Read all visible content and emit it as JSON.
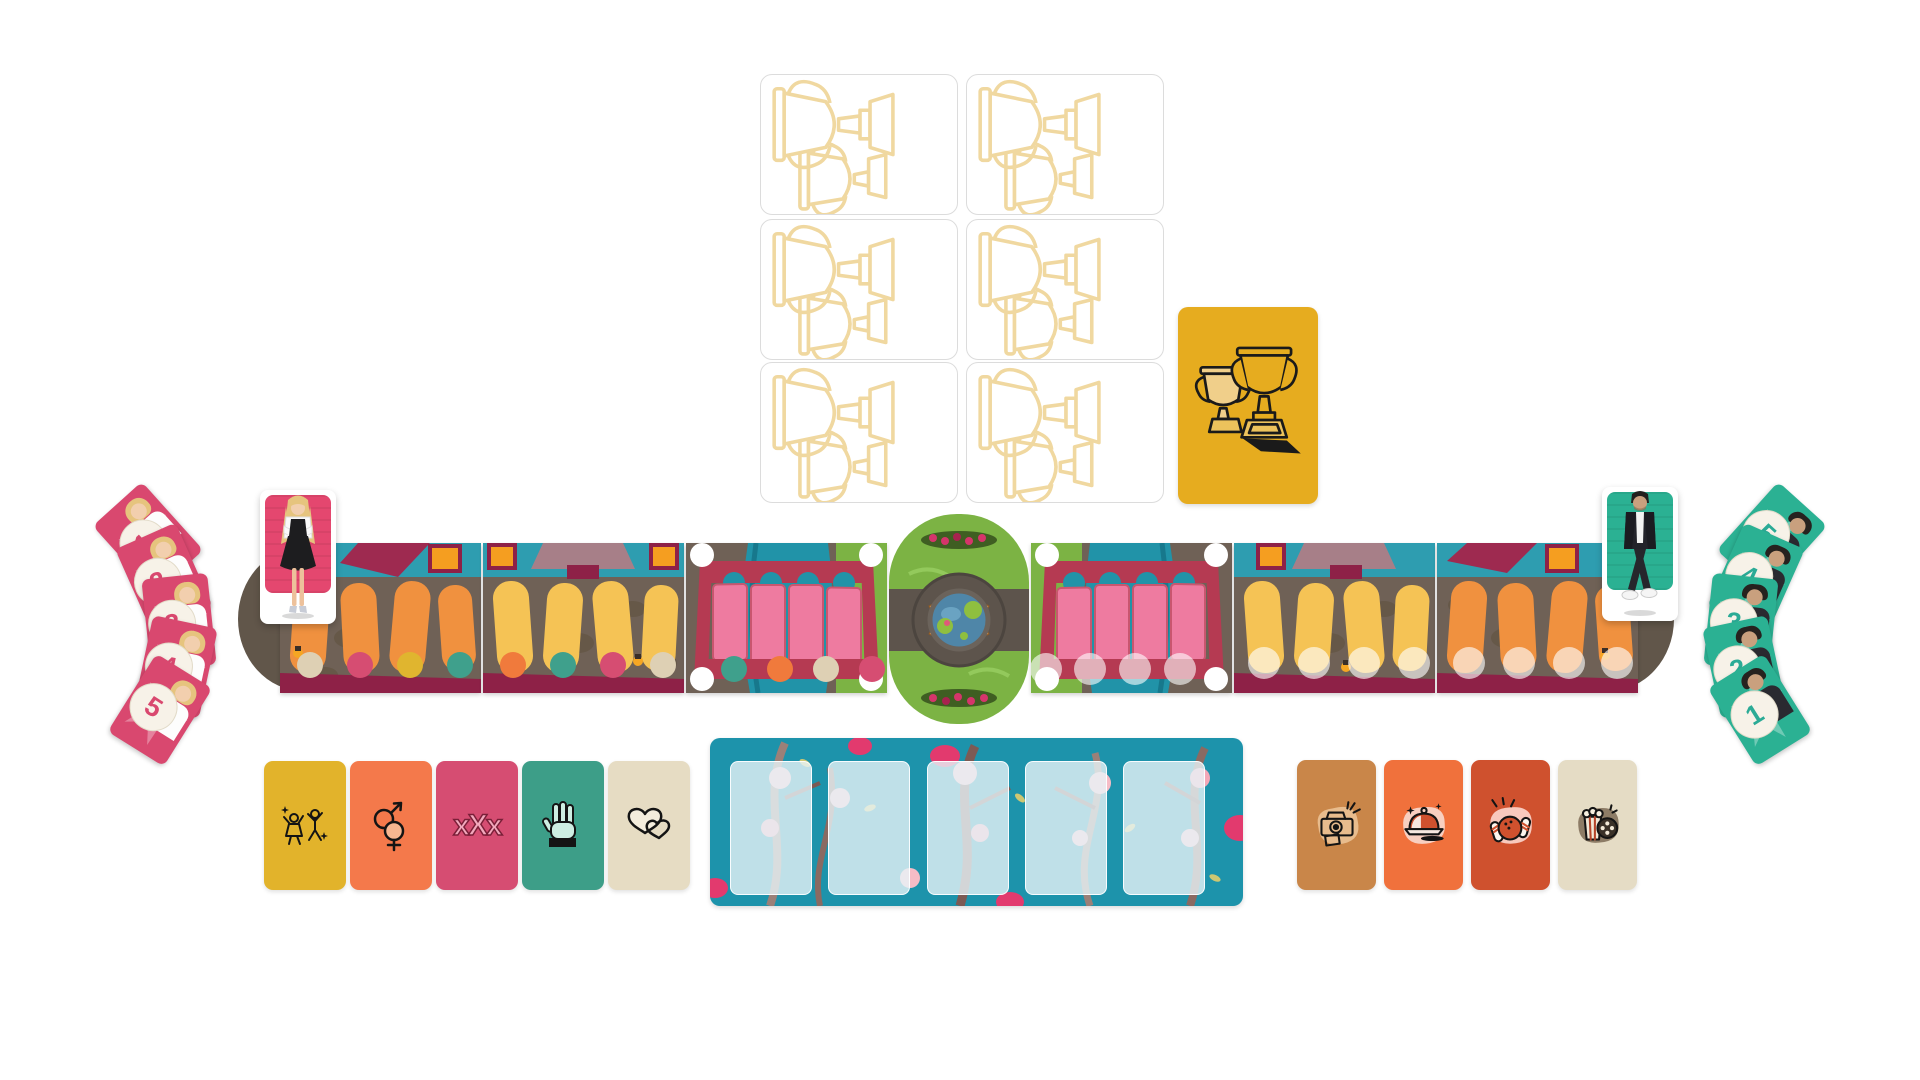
{
  "game": {
    "surface": "white table",
    "accent_colors": {
      "pink": "#d9486f",
      "teal": "#2bb193",
      "gold": "#e6ac1f",
      "board_stone": "#6f6156",
      "board_maroon": "#8e2147",
      "river": "#2193a8",
      "grass": "#7cb344",
      "flower_wall": "#1d93ab"
    }
  },
  "trophy_deck": {
    "description": "face-down trophy cards",
    "card_count": 6,
    "rows": 3,
    "cols": 2,
    "back_outline_color": "#f0d8a0"
  },
  "trophy_reveal": {
    "description": "revealed trophy card",
    "color": "#e6ac1f",
    "icon": "two-trophies"
  },
  "players": {
    "left": {
      "character": "blonde woman in black dress",
      "card_color": "#e4476f",
      "hand_color": "#d9486f",
      "hand": [
        {
          "value": "1"
        },
        {
          "value": "2"
        },
        {
          "value": "3"
        },
        {
          "value": "4"
        },
        {
          "value": "5"
        }
      ]
    },
    "right": {
      "character": "dark-haired man in black jacket",
      "card_color": "#2bb193",
      "hand_color": "#2bab96",
      "hand": [
        {
          "value": "5"
        },
        {
          "value": "4"
        },
        {
          "value": "3"
        },
        {
          "value": "2"
        },
        {
          "value": "1"
        }
      ]
    }
  },
  "board": {
    "tiles": [
      {
        "type": "street",
        "path_color": "#f0913f",
        "dots": [
          "#ded0b4",
          "#d64d72",
          "#e0b52f",
          "#3fa08c"
        ]
      },
      {
        "type": "street",
        "path_color": "#f5c355",
        "dots": [
          "#f07a3c",
          "#3fa08c",
          "#d64d72",
          "#ded0b4"
        ]
      },
      {
        "type": "bridge",
        "dots": [
          "#3fa08c",
          "#f07a3c",
          "#ded0b4",
          "#d64d72"
        ]
      },
      {
        "type": "garden",
        "features": [
          "pond",
          "benches",
          "rose-hedges"
        ]
      },
      {
        "type": "bridge",
        "dots": [
          "faded",
          "faded",
          "faded",
          "faded"
        ]
      },
      {
        "type": "street",
        "path_color": "#f5c355",
        "dots": [
          "faded",
          "faded",
          "faded",
          "faded"
        ]
      },
      {
        "type": "street",
        "path_color": "#f0913f",
        "dots": [
          "faded",
          "faded",
          "faded",
          "faded"
        ]
      }
    ]
  },
  "category_cards": [
    {
      "icon": "dancing-figures",
      "color": "#e2b32b"
    },
    {
      "icon": "gender-symbols",
      "color": "#f4794b"
    },
    {
      "icon": "xxx",
      "color": "#d64d72",
      "label": "xXx"
    },
    {
      "icon": "three-finger-hand",
      "color": "#3d9e88"
    },
    {
      "icon": "two-hearts",
      "color": "#e6dcc3"
    }
  ],
  "flower_board": {
    "color": "#1d93ab",
    "slot_count": 5,
    "decor": "magnolia branches"
  },
  "date_cards": [
    {
      "icon": "instant-camera",
      "color": "#c98649"
    },
    {
      "icon": "dinner-cloche",
      "color": "#f0713c"
    },
    {
      "icon": "bowling",
      "color": "#cf512e"
    },
    {
      "icon": "popcorn-movie",
      "color": "#e5dcc5"
    }
  ]
}
